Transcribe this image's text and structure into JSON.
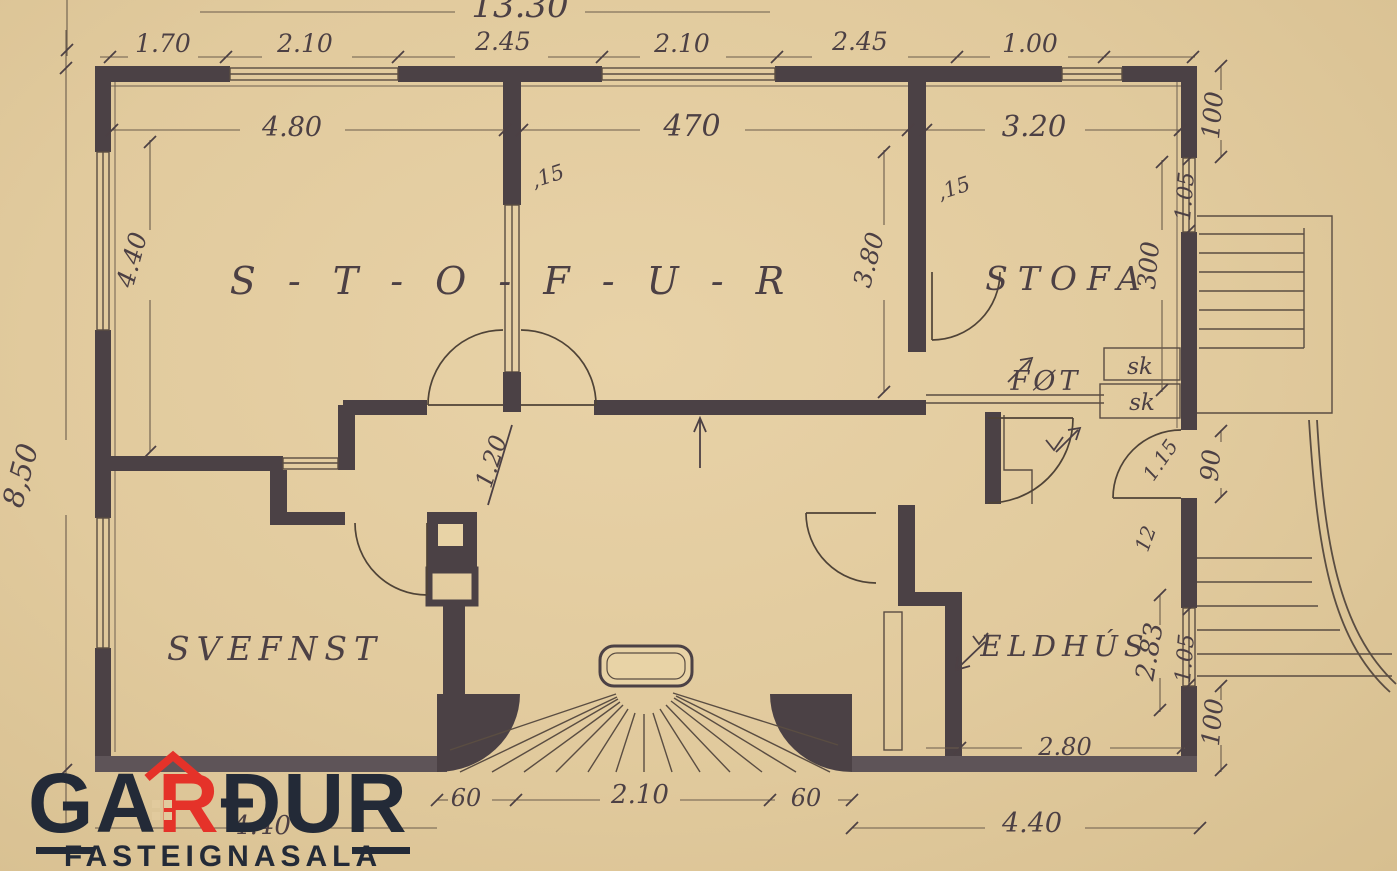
{
  "canvas": {
    "paper": "#e3cca0",
    "ink": "#4a4044",
    "wall_grey": "#5e5458"
  },
  "logo": {
    "part1": "GA",
    "accent": "R",
    "part2": "ÐUR",
    "subtitle": "FASTEIGNASALA",
    "navy": "#232a37",
    "red": "#e53229"
  },
  "rooms": {
    "stofur": "S - T - O - F - U - R",
    "stofa": "STOFA",
    "svefnst": "SVEFNST",
    "eldhus": "ELDHÚS",
    "fot": "FØT",
    "sk_upper": "sk",
    "sk_lower": "sk"
  },
  "dims": {
    "overall_top": "13.30",
    "overall_left": "8,50",
    "top_segments": [
      "1.70",
      "2.10",
      "2.45",
      "2.10",
      "2.45",
      "1.00"
    ],
    "room_widths": [
      "4.80",
      "470",
      "3.20"
    ],
    "left_room_height": "4.40",
    "mid_wall_height": "3.80",
    "stofa_height": "300",
    "wall_thickness_left": ",15",
    "wall_thickness_right": ",15",
    "hall_width": "1.20",
    "right_top": "100",
    "right_window_upper": "1.05",
    "door_right": "90",
    "door_diagonal": "1.15",
    "wall_small": "12",
    "kitchen_height": "2.83",
    "right_window_lower": "1.05",
    "right_bottom": "100",
    "kitchen_width": "2.80",
    "entry_left": "60",
    "entry_center": "2.10",
    "entry_right": "60",
    "bottom_left": "4.40",
    "bottom_right": "4.40"
  }
}
